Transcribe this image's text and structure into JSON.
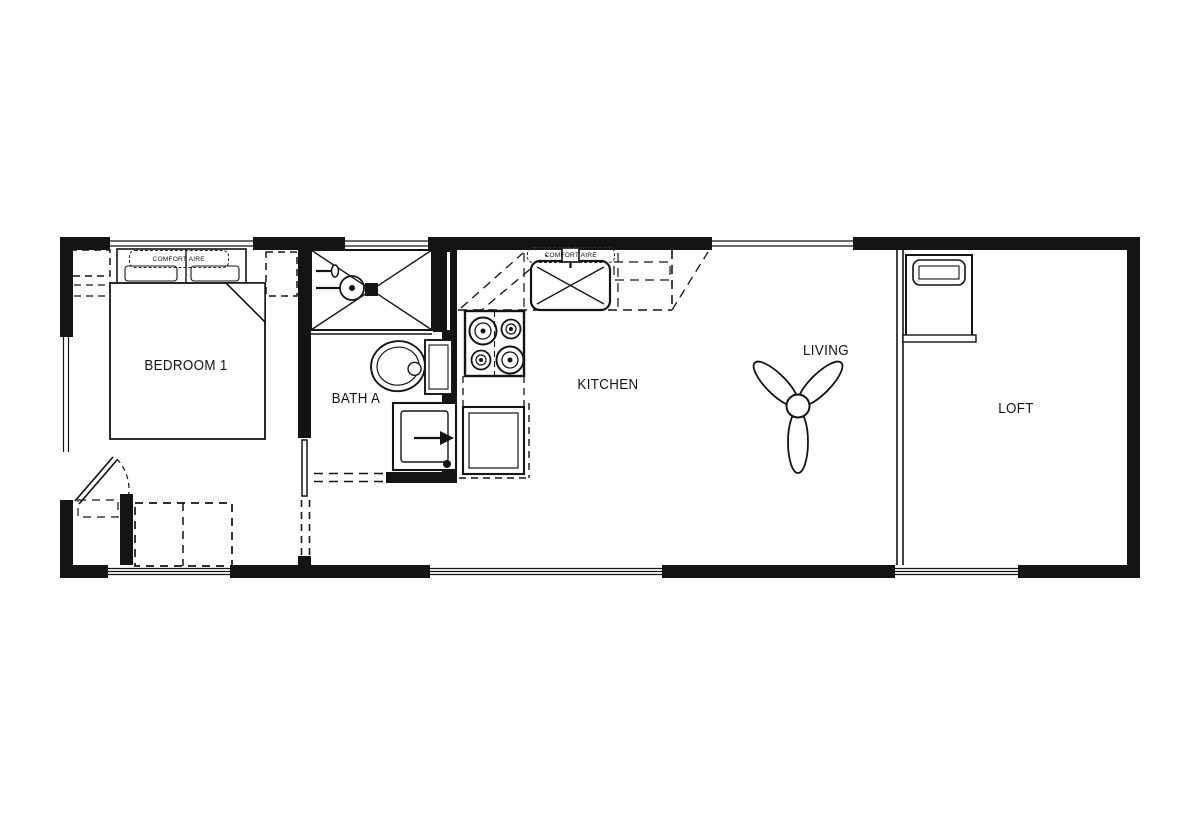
{
  "floor_plan": {
    "rooms": [
      {
        "name": "bedroom-1",
        "label": "BEDROOM 1"
      },
      {
        "name": "bath-a",
        "label": "BATH A"
      },
      {
        "name": "kitchen",
        "label": "KITCHEN"
      },
      {
        "name": "living",
        "label": "LIVING"
      },
      {
        "name": "loft",
        "label": "LOFT"
      }
    ],
    "equipment_labels": [
      {
        "name": "bedroom-ac-unit",
        "label": "COMFORT AIRE"
      },
      {
        "name": "kitchen-ac-unit",
        "label": "COMFORT AIRE"
      }
    ],
    "fixtures": [
      "bed",
      "overhead-cabinets",
      "entry-door",
      "wardrobe",
      "pocket-door",
      "shower",
      "toilet",
      "washer-dryer",
      "range",
      "refrigerator",
      "kitchen-sink",
      "kitchen-counter",
      "ceiling-fan",
      "loft-steps",
      "windows"
    ],
    "colors": {
      "line": "#141414",
      "background": "#ffffff"
    }
  }
}
